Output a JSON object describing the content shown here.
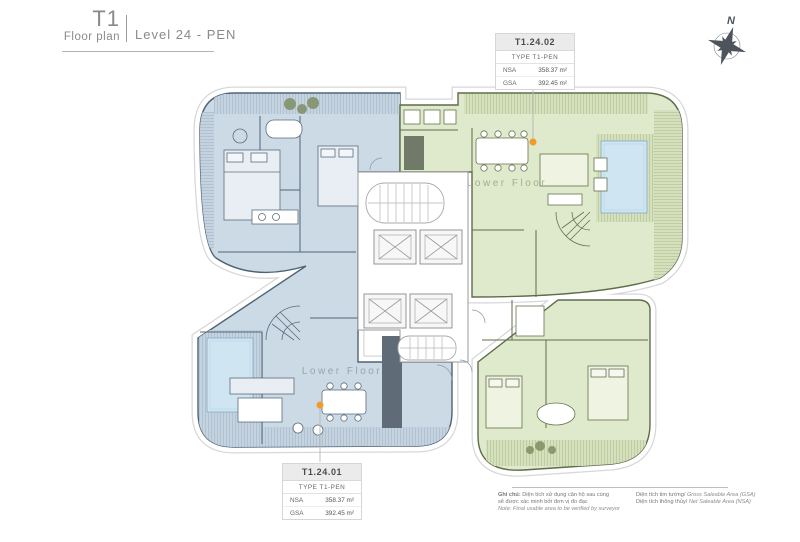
{
  "header": {
    "project": "T1",
    "subtitle": "Floor plan",
    "level": "Level 24 - PEN"
  },
  "compass": {
    "label": "N"
  },
  "units": [
    {
      "id": "T1.24.01",
      "type_label": "TYPE T1-PEN",
      "nsa_label": "NSA",
      "nsa_value": "358.37 m²",
      "gsa_label": "GSA",
      "gsa_value": "392.45 m²",
      "floor_label": "Lower Floor"
    },
    {
      "id": "T1.24.02",
      "type_label": "TYPE T1-PEN",
      "nsa_label": "NSA",
      "nsa_value": "358.37 m²",
      "gsa_label": "GSA",
      "gsa_value": "392.45 m²",
      "floor_label": "Lower Floor"
    }
  ],
  "footer": {
    "note_label": "Ghi chú:",
    "note_vi_1": " Diện tích sử dụng căn hộ sau cùng",
    "note_vi_2": "sẽ được xác minh bởi đơn vị đo đạc",
    "note_en": "Note: Final usable area to be verified by surveyor",
    "gsa_vi": "Diện tích tim tường/ ",
    "gsa_en": "Gross Saleable Area (GSA)",
    "nsa_vi": "Diện tích thông thủy/ ",
    "nsa_en": "Net Saleable Area (NSA)"
  },
  "colors": {
    "unit1_fill": "#ccdae5",
    "unit1_wall": "#4f6375",
    "unit2_fill": "#dfe9cc",
    "unit2_wall": "#5e6b4c",
    "pool_fill": "#cfe6f2",
    "leader_dot": "#f09a2f",
    "outline_halo": "#d7d7d7"
  }
}
